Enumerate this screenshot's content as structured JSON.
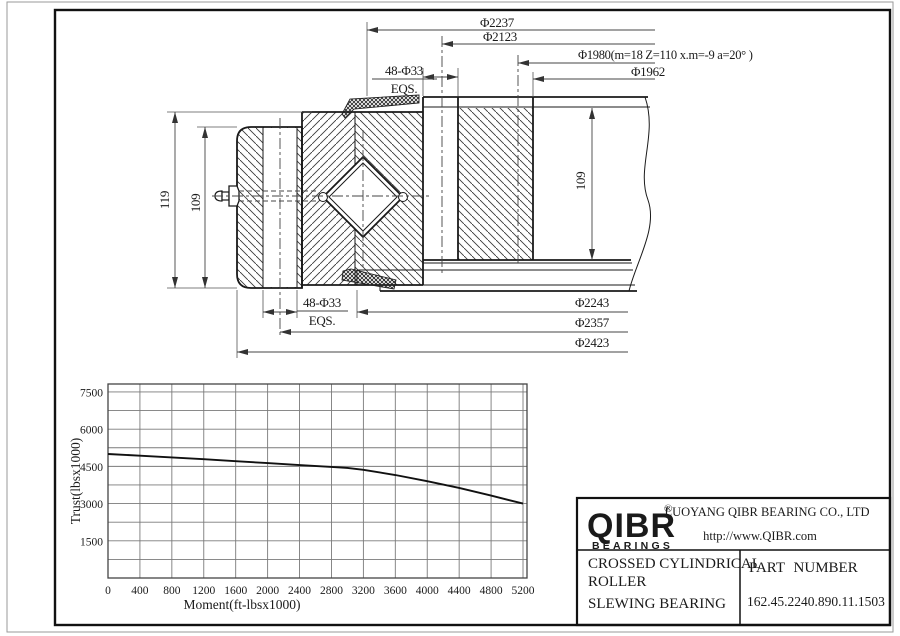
{
  "drawing": {
    "dim_phi2237": "Φ2237",
    "dim_phi2123": "Φ2123",
    "dim_gear": "Φ1980(m=18 Z=110 x.m=-9 a=20° )",
    "dim_phi1962": "Φ1962",
    "bolt_top_line1": "48-Φ33",
    "bolt_top_line2": "EQS.",
    "bolt_bottom_line1": "48-Φ33",
    "bolt_bottom_line2": "EQS.",
    "height_total": "119",
    "height_ring_left": "109",
    "height_ring_right": "109",
    "dim_phi2243": "Φ2243",
    "dim_phi2357": "Φ2357",
    "dim_phi2423": "Φ2423"
  },
  "chart_data": {
    "type": "line",
    "xlabel": "Moment(ft-lbsx1000)",
    "ylabel": "Trust(lbsx1000)",
    "xlim": [
      0,
      5250
    ],
    "ylim": [
      0,
      7820
    ],
    "x_ticks": [
      0,
      400,
      800,
      1200,
      1600,
      2000,
      2400,
      2800,
      3200,
      3600,
      4000,
      4400,
      4800,
      5200
    ],
    "y_ticks": [
      1500,
      3000,
      4500,
      6000,
      7500
    ],
    "x_grid_step": 400,
    "y_grid_step": 750,
    "grid": true,
    "legend": "none",
    "series": [
      {
        "name": "static load limit curve",
        "points": [
          [
            0,
            5000
          ],
          [
            400,
            4930
          ],
          [
            800,
            4860
          ],
          [
            1200,
            4790
          ],
          [
            1600,
            4710
          ],
          [
            2000,
            4630
          ],
          [
            2400,
            4550
          ],
          [
            2800,
            4480
          ],
          [
            3000,
            4440
          ],
          [
            3200,
            4360
          ],
          [
            3600,
            4150
          ],
          [
            4000,
            3900
          ],
          [
            4400,
            3630
          ],
          [
            4800,
            3320
          ],
          [
            5200,
            3000
          ]
        ]
      }
    ]
  },
  "title_block": {
    "logo": "QIBR",
    "logo_registered": "®",
    "logo_sub": "BEARINGS",
    "company": "LUOYANG QIBR BEARING CO., LTD",
    "website": "http://www.QIBR.com",
    "product_line1": "CROSSED CYLINDRICAL",
    "product_line2": "ROLLER",
    "product_line3": "SLEWING BEARING",
    "part_number_label": "PART NUMBER",
    "part_number": "162.45.2240.890.11.1503"
  }
}
